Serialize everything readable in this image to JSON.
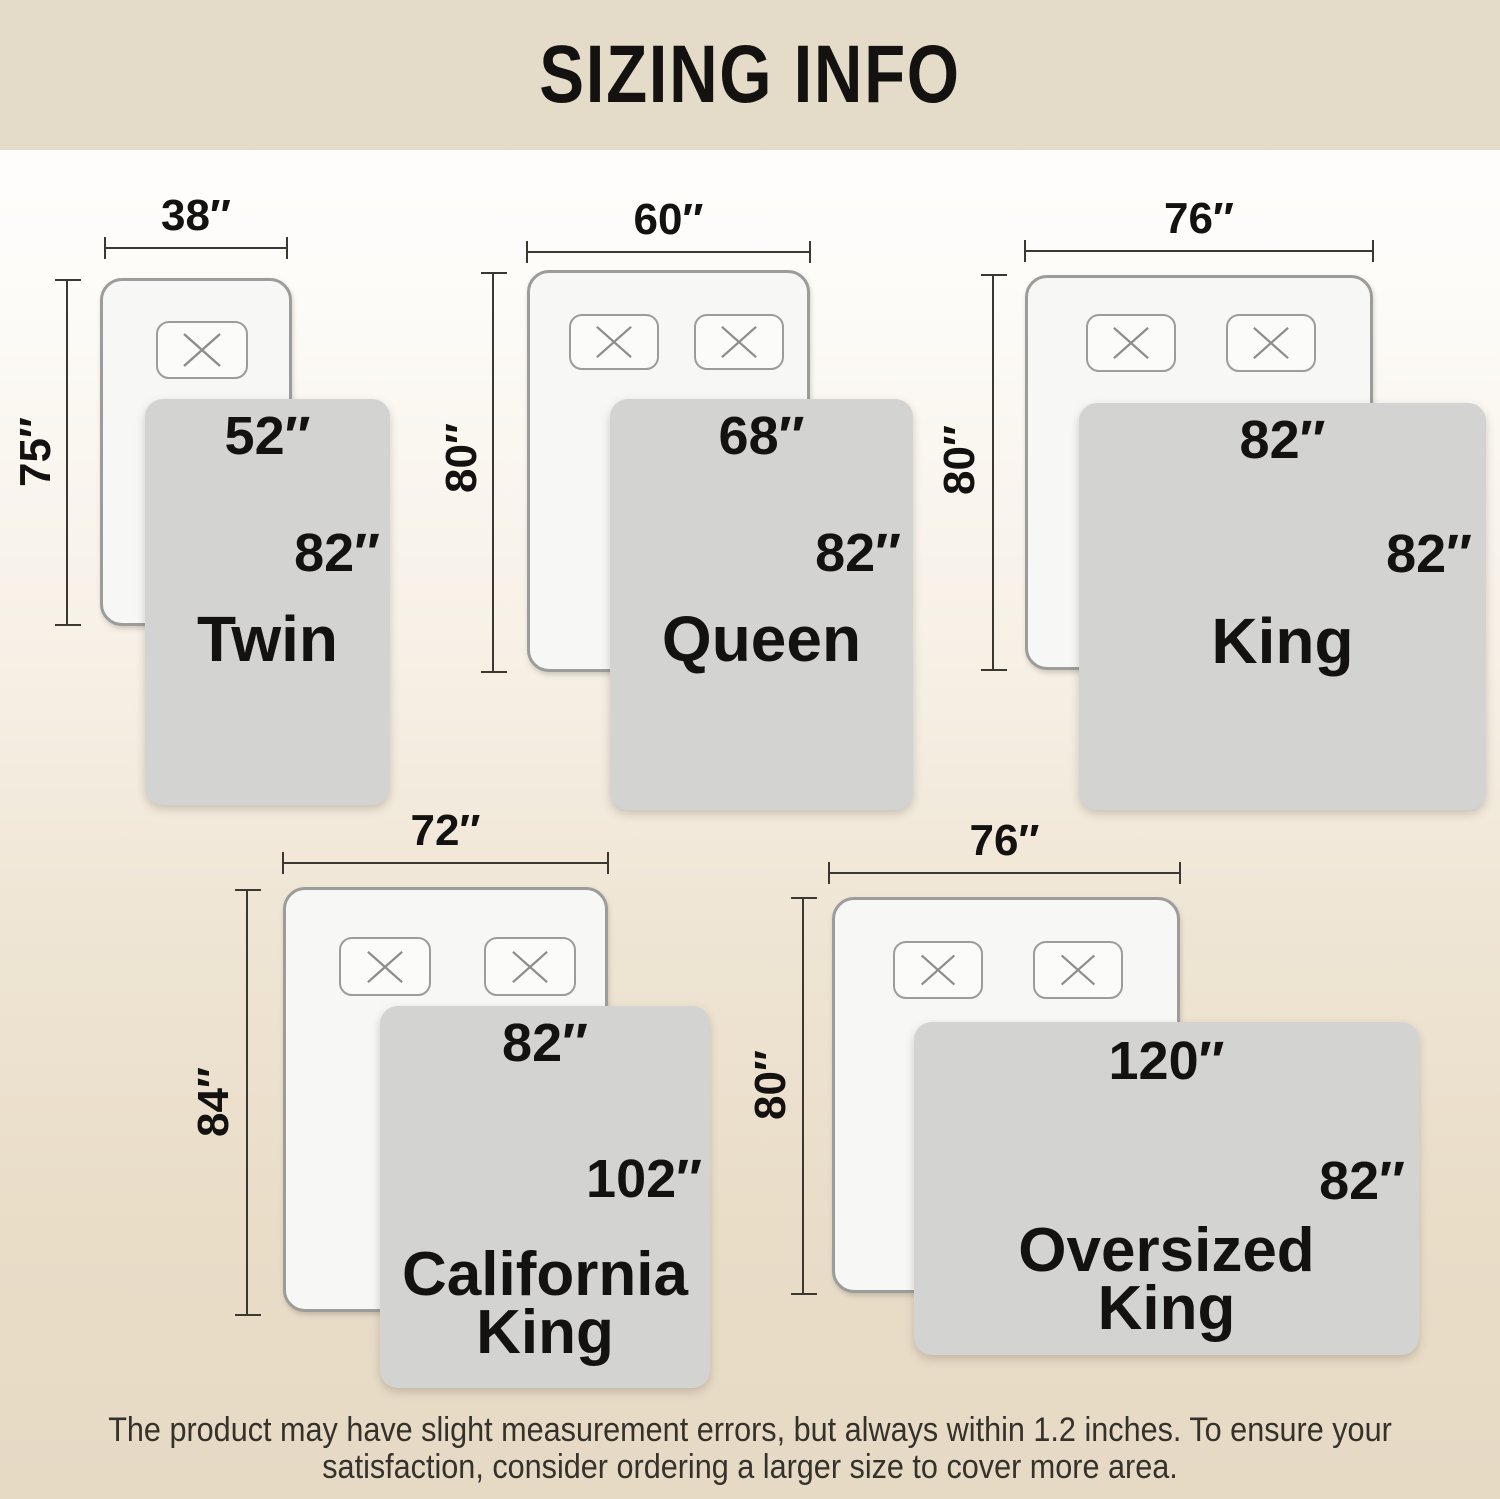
{
  "header": {
    "title": "SIZING INFO"
  },
  "sizes": [
    {
      "name": "Twin",
      "mattress_width": "38″",
      "mattress_length": "75″",
      "blanket_width": "52″",
      "blanket_length": "82″",
      "pillow_count": 1
    },
    {
      "name": "Queen",
      "mattress_width": "60″",
      "mattress_length": "80″",
      "blanket_width": "68″",
      "blanket_length": "82″",
      "pillow_count": 2
    },
    {
      "name": "King",
      "mattress_width": "76″",
      "mattress_length": "80″",
      "blanket_width": "82″",
      "blanket_length": "82″",
      "pillow_count": 2
    },
    {
      "name": "California King",
      "mattress_width": "72″",
      "mattress_length": "84″",
      "blanket_width": "82″",
      "blanket_length": "102″",
      "pillow_count": 2
    },
    {
      "name": "Oversized King",
      "mattress_width": "76″",
      "mattress_length": "80″",
      "blanket_width": "120″",
      "blanket_length": "82″",
      "pillow_count": 2
    }
  ],
  "footer": {
    "line1": "The product may have slight measurement errors, but always within 1.2 inches. To ensure your",
    "line2": "satisfaction, consider ordering a larger size to cover more area."
  },
  "colors": {
    "banner": "#e4dbc8",
    "background_bottom": "#e6dac5",
    "blanket": "#d3d3d1",
    "mattress": "#f7f7f5",
    "outline": "#9c9c9a",
    "dim": "#3b3731",
    "ink": "#141210"
  }
}
